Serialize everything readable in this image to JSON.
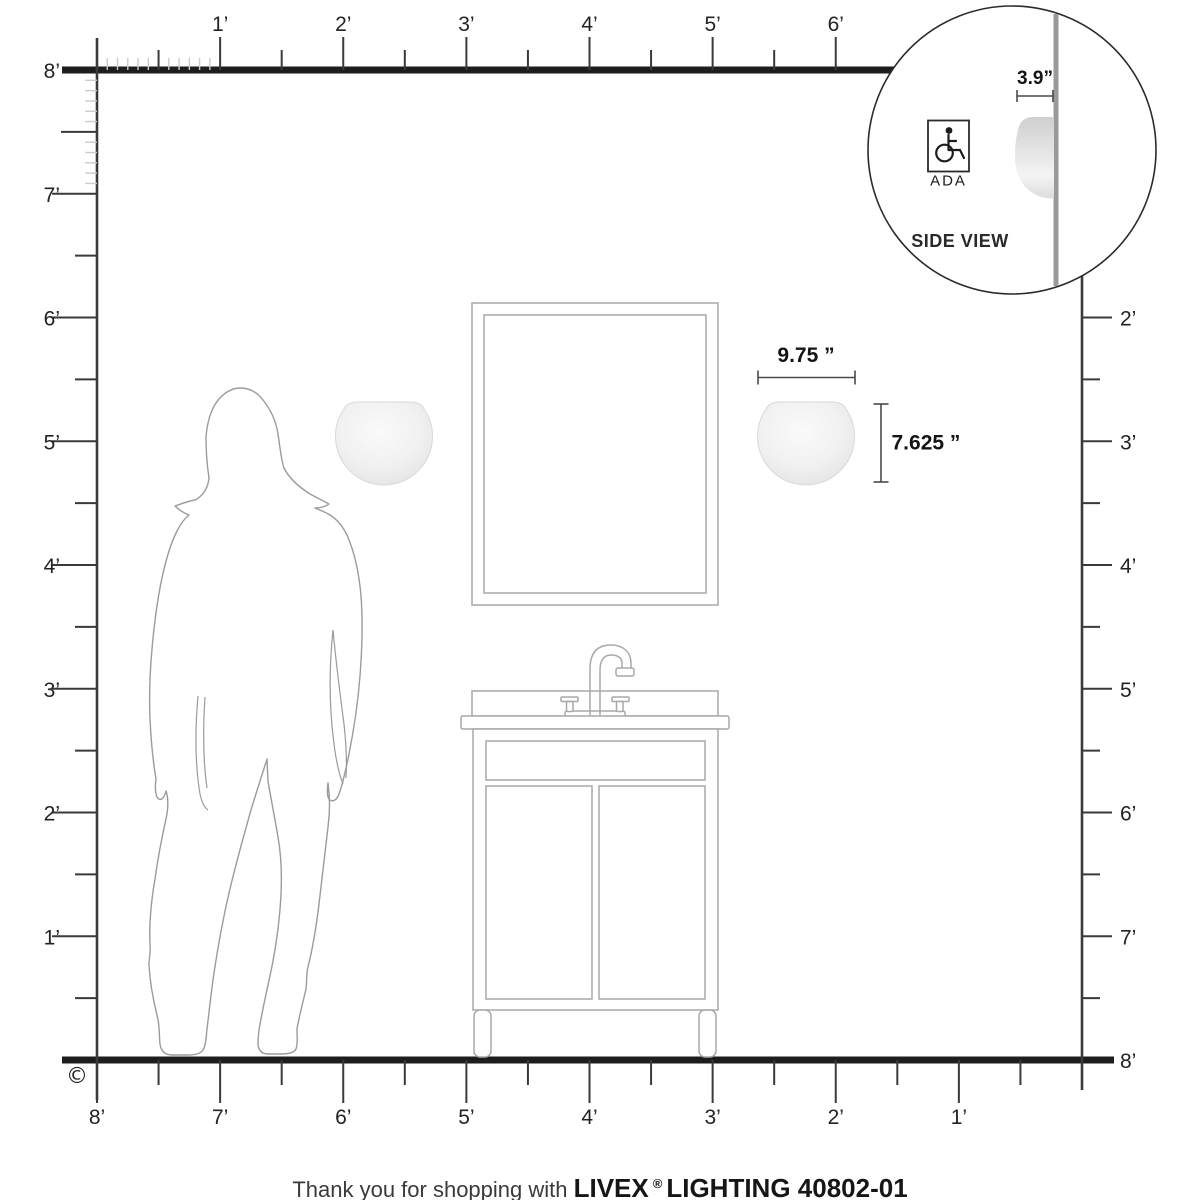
{
  "colors": {
    "ink": "#1d1d1d",
    "wall": "#3a3a3a",
    "tick_light": "#cbcbcb",
    "furniture": "#a8a8a8",
    "silhouette": "#9b9b9b",
    "dim": "#4a4a4a",
    "inset_wall": "#9a9a9a",
    "sconce_edge": "#d9d9d9"
  },
  "rulers": {
    "top": {
      "unit_labels": [
        "1’",
        "2’",
        "3’",
        "4’",
        "5’",
        "6’"
      ]
    },
    "left": {
      "unit_labels": [
        "8’",
        "7’",
        "6’",
        "5’",
        "4’",
        "3’",
        "2’",
        "1’"
      ]
    },
    "right": {
      "unit_labels": [
        "2’",
        "3’",
        "4’",
        "5’",
        "6’",
        "7’",
        "8’"
      ]
    },
    "bottom": {
      "unit_labels": [
        "8’",
        "7’",
        "6’",
        "5’",
        "4’",
        "3’",
        "2’",
        "1’"
      ]
    }
  },
  "dimensions": {
    "width_label": "9.75 ”",
    "height_label": "7.625 ”",
    "depth_label": "3.9”"
  },
  "inset": {
    "ada_label": "ADA",
    "caption": "SIDE VIEW",
    "icons": {
      "wheelchair": "wheelchair-outline"
    }
  },
  "copyright_symbol": "©",
  "footer": {
    "prefix": "Thank you for shopping with ",
    "brand": "LIVEX",
    "registered_mark": "®",
    "suffix": " LIGHTING 40802-01"
  }
}
